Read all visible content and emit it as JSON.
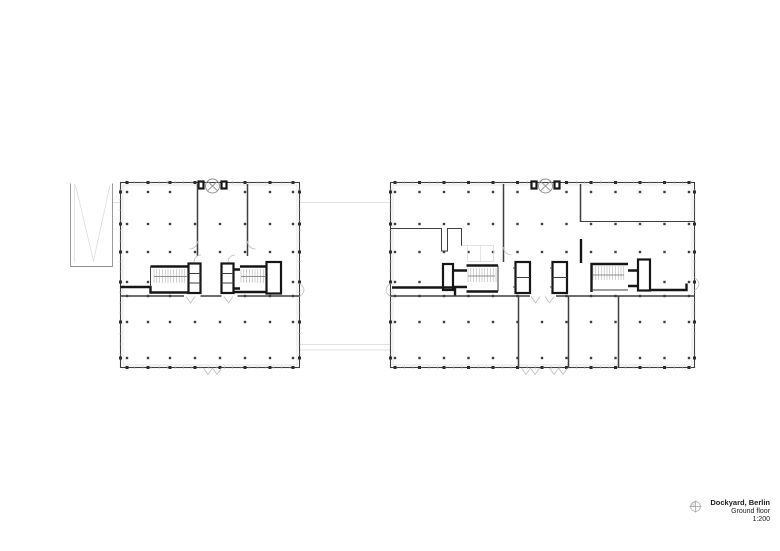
{
  "title_block": {
    "project": "Dockyard, Berlin",
    "floor": "Ground floor",
    "scale": "1:200",
    "icon": "north-compass-icon"
  },
  "plan": {
    "type": "architectural-floor-plan",
    "buildings": [
      "left-block",
      "right-block"
    ],
    "site_elements": [
      "parking-ramp",
      "site-connector-lines"
    ]
  },
  "colors": {
    "paper": "#ffffff",
    "ink": "#3f3f3f",
    "heavy": "#161616",
    "mid": "#8f8f8f",
    "light": "#bfbfbf",
    "faint": "#d9d9d9",
    "text": "#1c1c1c"
  }
}
